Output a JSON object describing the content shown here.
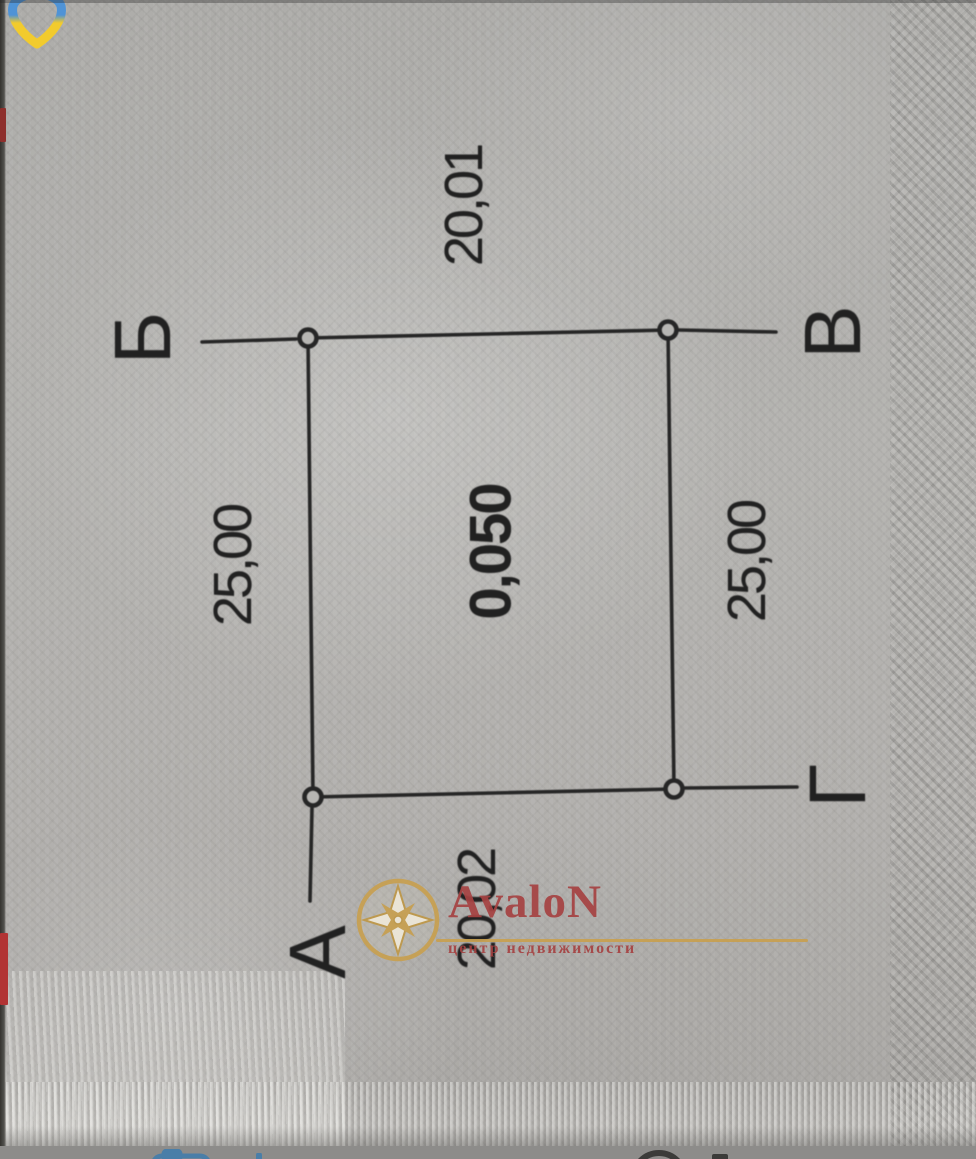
{
  "plan": {
    "corner_labels": {
      "top_left": "Б",
      "top_right": "В",
      "bottom_right": "Г",
      "bottom_left": "А"
    },
    "dimensions": {
      "top": "20,01",
      "left": "25,00",
      "right": "25,00",
      "bottom": "20,02"
    },
    "area": "0,050"
  },
  "watermark": {
    "brand": "AvaloN",
    "tagline": "центр недвижимости",
    "brand_color": "#a64242",
    "accent_gold": "#c8a050"
  },
  "icons": {
    "overlay_logo": "ukraine-pin-icon",
    "bottom_bar": [
      "camera-icon",
      "add-icon",
      "record-circle-icon",
      "stop-square-icon"
    ]
  },
  "colors": {
    "paper": "#b3b1ae",
    "ink": "#212121",
    "toolbar_bg": "#8d8c8a",
    "toolbar_icon_blue": "#4a7ea8",
    "toolbar_icon_dark": "#3b3b39",
    "pin_blue": "#4f93d6",
    "pin_yellow": "#f2cb2d",
    "edge_red": "#b23434"
  }
}
